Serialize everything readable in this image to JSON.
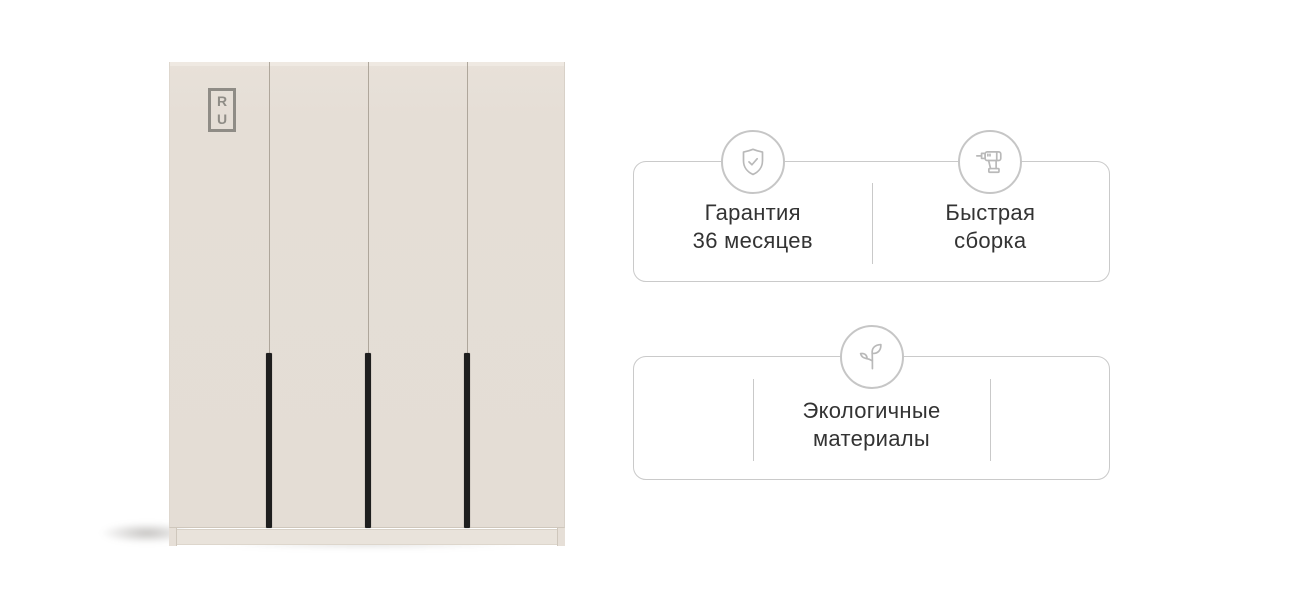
{
  "background_color": "#ffffff",
  "wardrobe": {
    "door_count": 4,
    "handle_count": 3,
    "logo": {
      "top_letter": "R",
      "bottom_letter": "U"
    },
    "colors": {
      "door": "#e5ded6",
      "door_top_edge": "#efe9e2",
      "seam": "#a59c90",
      "handle": "#1e1e1e",
      "plinth": "#e9e3db",
      "logo": "#8f8c86"
    }
  },
  "feature_cards": {
    "border_color": "#cacaca",
    "icon_color": "#b9b9b9",
    "text_color": "#333333",
    "card1": {
      "items": [
        {
          "icon": "shield-check-icon",
          "line1": "Гарантия",
          "line2": "36 месяцев"
        },
        {
          "icon": "drill-icon",
          "line1": "Быстрая",
          "line2": "сборка"
        }
      ]
    },
    "card2": {
      "items": [
        {
          "icon": "leaf-icon",
          "line1": "Экологичные",
          "line2": "материалы"
        }
      ]
    }
  }
}
